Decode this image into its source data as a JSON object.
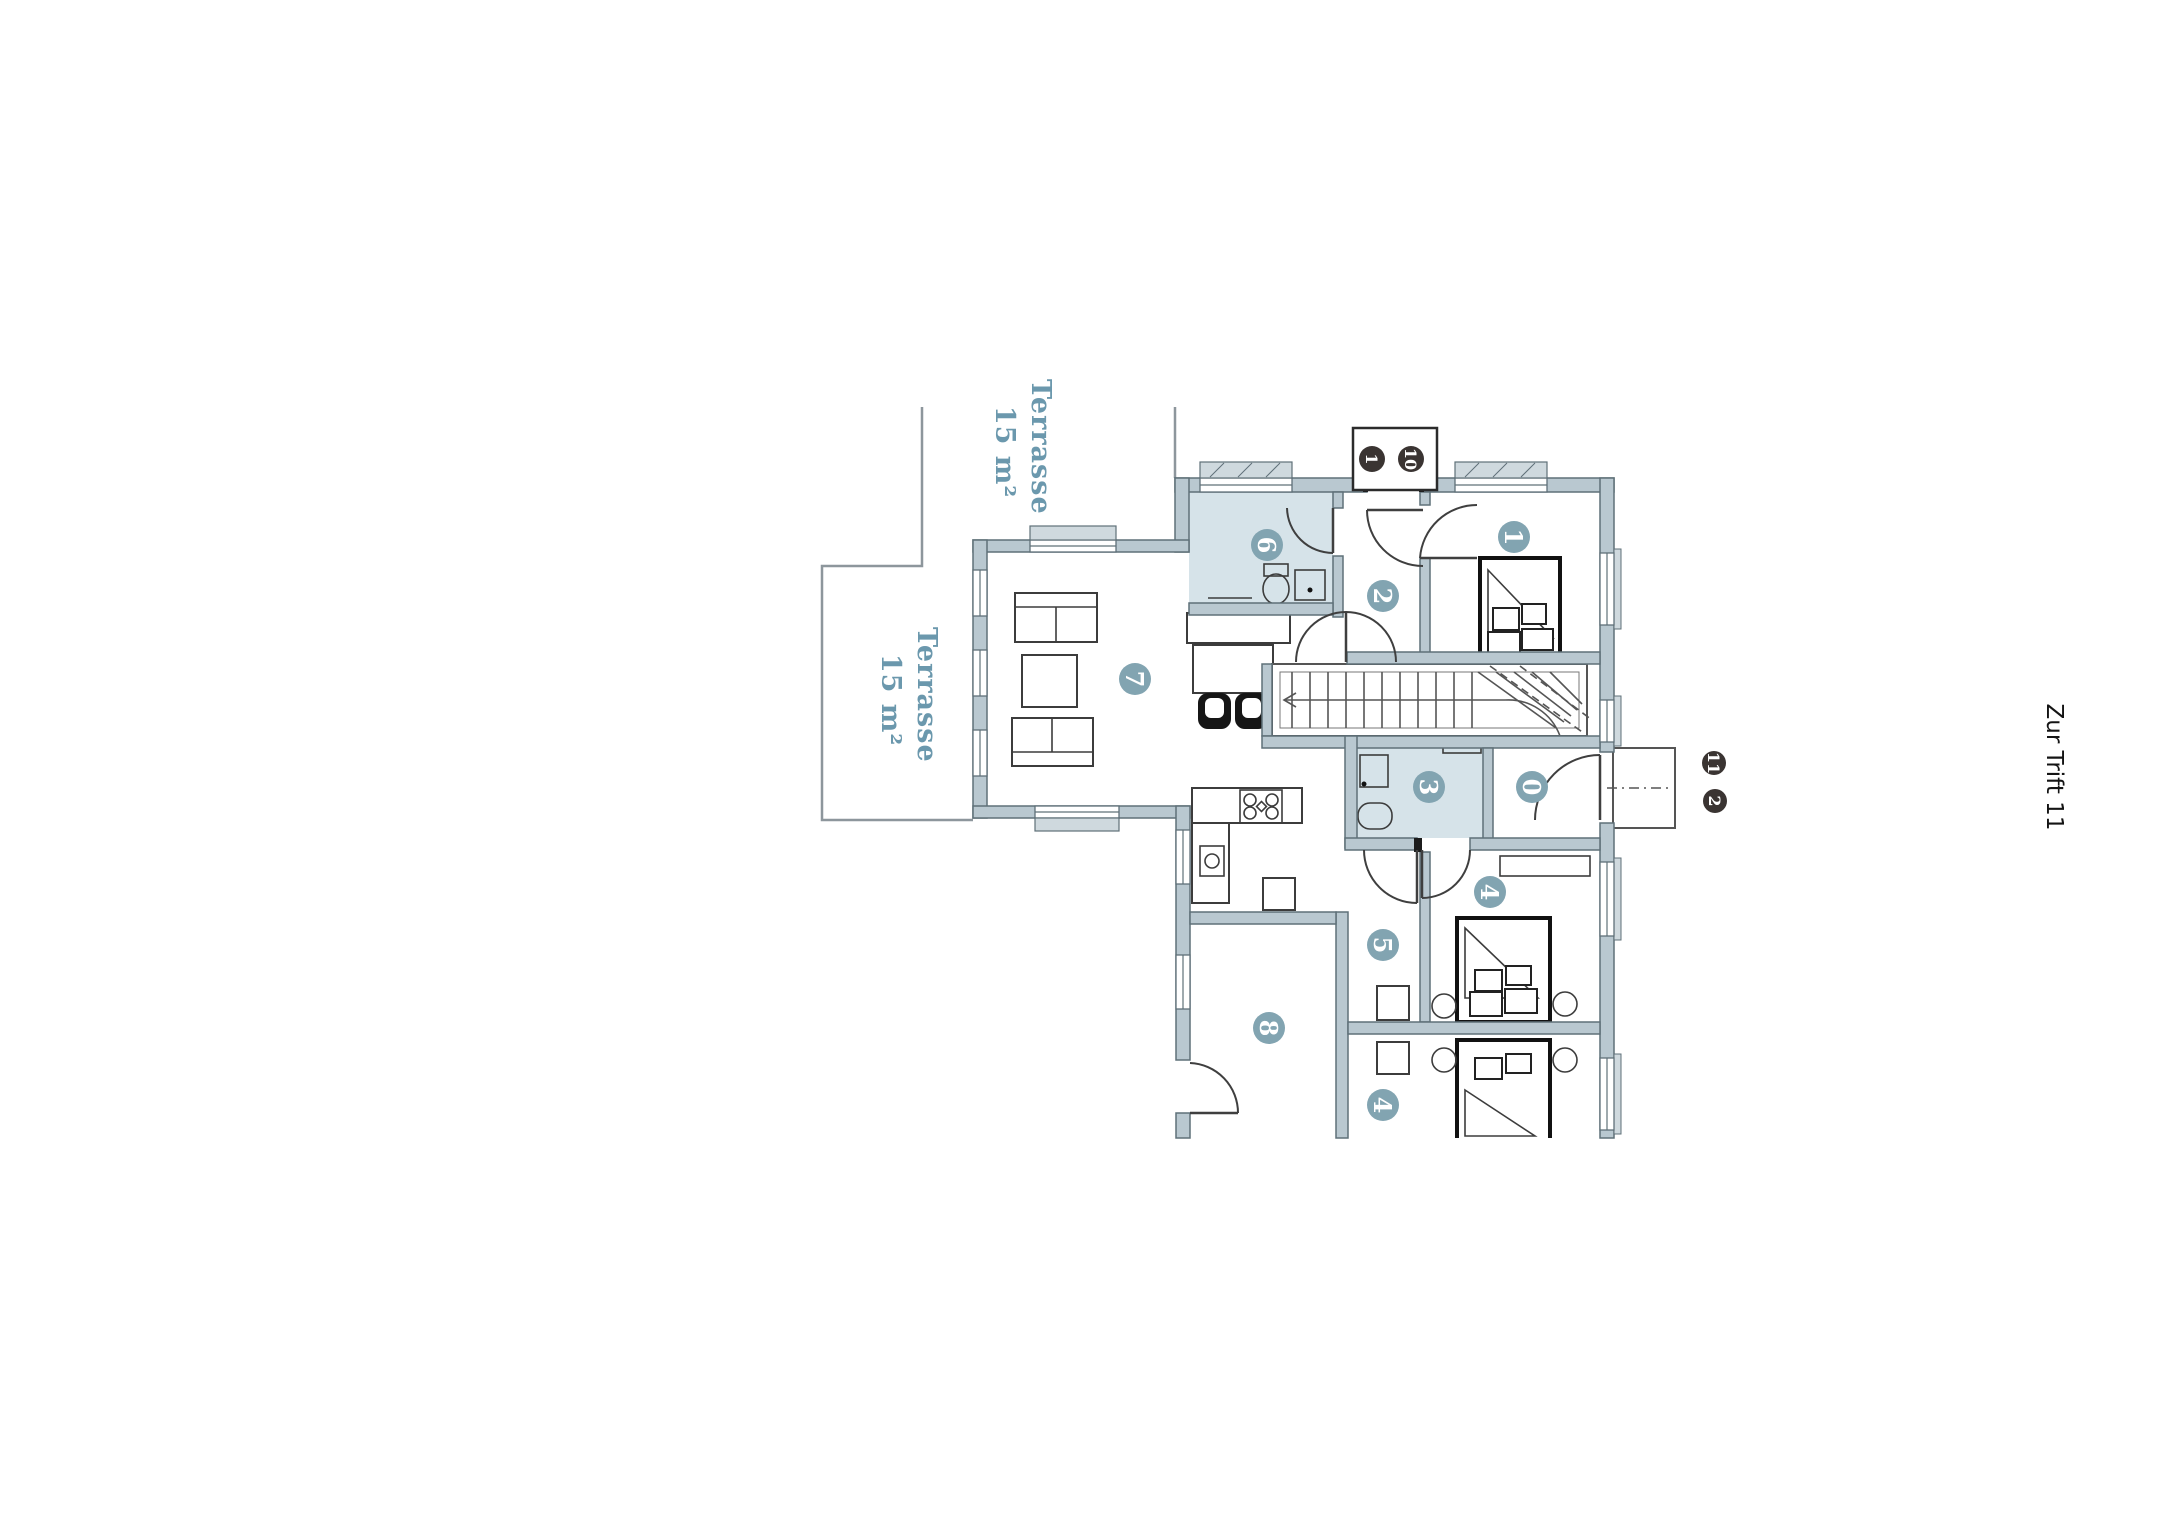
{
  "street_label": "Zur Trift 11",
  "terraces": [
    {
      "name": "Terrasse",
      "area": "15 m²"
    },
    {
      "name": "Terrasse",
      "area": "15 m²"
    }
  ],
  "badges": {
    "stairwell_top": [
      "1",
      "10"
    ],
    "entrance_right": [
      "11",
      "2"
    ]
  },
  "rooms": [
    {
      "id": "bedroom-1",
      "label": "1"
    },
    {
      "id": "hallway",
      "label": "2"
    },
    {
      "id": "bathroom-small",
      "label": "3"
    },
    {
      "id": "bedroom-2",
      "label": "4"
    },
    {
      "id": "hall",
      "label": "5"
    },
    {
      "id": "bathroom-main",
      "label": "6"
    },
    {
      "id": "living-room",
      "label": "7"
    },
    {
      "id": "room-8",
      "label": "8"
    },
    {
      "id": "entry",
      "label": "0"
    },
    {
      "id": "bedroom-3",
      "label": "4"
    }
  ],
  "colors": {
    "wall": "#b9c8d0",
    "wall_stroke": "#5f7078",
    "bathroom_fill": "#d6e3e9",
    "room_circle": "#82a4b1",
    "badge_dark": "#3a3432",
    "terrace_text": "#6b98ad"
  }
}
